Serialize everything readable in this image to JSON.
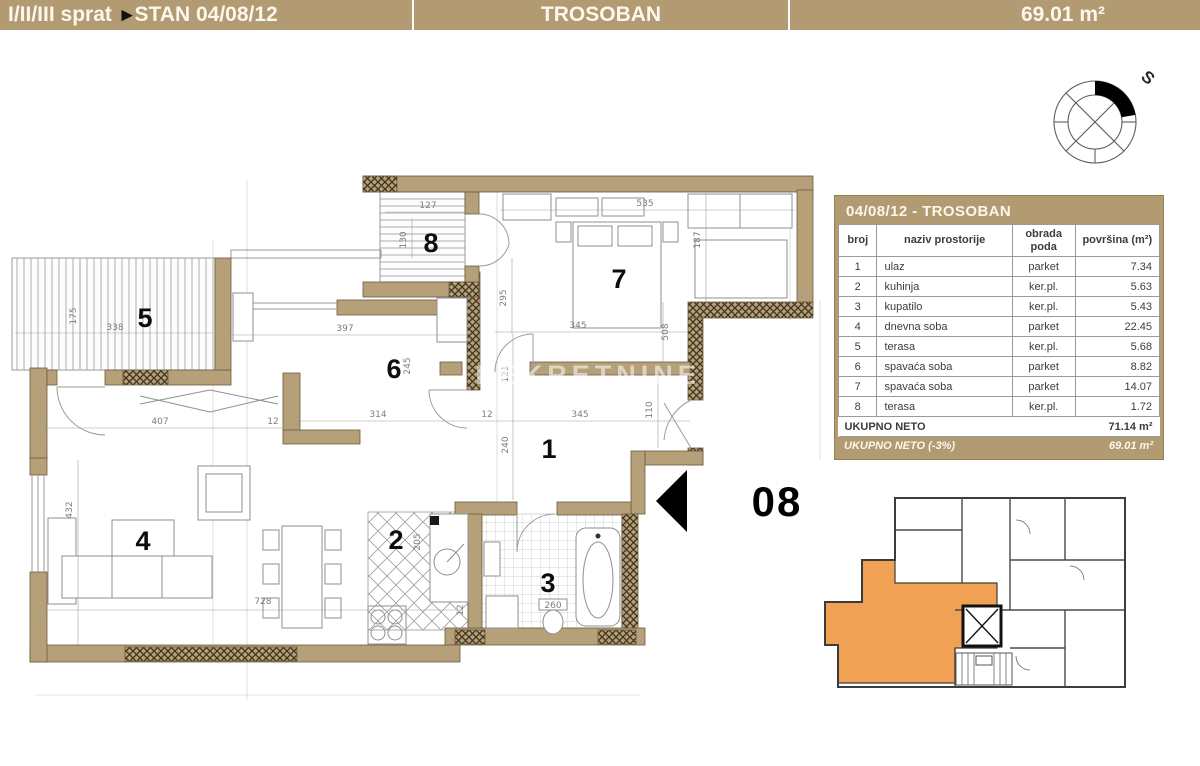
{
  "header": {
    "floors": "I/II/III sprat",
    "arrow_icon": "►",
    "unit": "STAN 04/08/12",
    "type": "TROSOBAN",
    "area": "69.01 m²"
  },
  "compass": {
    "north_label": "S"
  },
  "watermark": "NEKRETNINE",
  "unit_marker": {
    "label": "08"
  },
  "plan": {
    "rooms": [
      {
        "n": "5",
        "x": 145,
        "y": 327
      },
      {
        "n": "8",
        "x": 431,
        "y": 252
      },
      {
        "n": "7",
        "x": 619,
        "y": 288
      },
      {
        "n": "6",
        "x": 394,
        "y": 378
      },
      {
        "n": "1",
        "x": 549,
        "y": 458
      },
      {
        "n": "4",
        "x": 143,
        "y": 550
      },
      {
        "n": "2",
        "x": 396,
        "y": 549
      },
      {
        "n": "3",
        "x": 548,
        "y": 592
      }
    ],
    "dimensions": [
      {
        "t": "338",
        "x": 115,
        "y": 330
      },
      {
        "t": "175",
        "x": 76,
        "y": 316,
        "r": 1
      },
      {
        "t": "407",
        "x": 160,
        "y": 424
      },
      {
        "t": "12",
        "x": 273,
        "y": 424
      },
      {
        "t": "314",
        "x": 378,
        "y": 417
      },
      {
        "t": "12",
        "x": 487,
        "y": 417
      },
      {
        "t": "345",
        "x": 580,
        "y": 417
      },
      {
        "t": "121",
        "x": 508,
        "y": 374,
        "r": 1
      },
      {
        "t": "240",
        "x": 508,
        "y": 445,
        "r": 1
      },
      {
        "t": "110",
        "x": 652,
        "y": 410,
        "r": 1
      },
      {
        "t": "508",
        "x": 668,
        "y": 332,
        "r": 1
      },
      {
        "t": "345",
        "x": 578,
        "y": 328
      },
      {
        "t": "295",
        "x": 506,
        "y": 298,
        "r": 1
      },
      {
        "t": "535",
        "x": 645,
        "y": 206
      },
      {
        "t": "187",
        "x": 700,
        "y": 240,
        "r": 1
      },
      {
        "t": "127",
        "x": 428,
        "y": 208
      },
      {
        "t": "130",
        "x": 406,
        "y": 240,
        "r": 1
      },
      {
        "t": "397",
        "x": 345,
        "y": 331
      },
      {
        "t": "245",
        "x": 410,
        "y": 366,
        "r": 1
      },
      {
        "t": "432",
        "x": 72,
        "y": 510,
        "r": 1
      },
      {
        "t": "728",
        "x": 263,
        "y": 604
      },
      {
        "t": "205",
        "x": 420,
        "y": 542,
        "r": 1
      },
      {
        "t": "12",
        "x": 463,
        "y": 610,
        "r": 1
      },
      {
        "t": "260",
        "x": 553,
        "y": 608
      }
    ]
  },
  "table": {
    "title": "04/08/12 - TROSOBAN",
    "columns": [
      "broj",
      "naziv prostorije",
      "obrada poda",
      "površina (m²)"
    ],
    "rows": [
      [
        "1",
        "ulaz",
        "parket",
        "7.34"
      ],
      [
        "2",
        "kuhinja",
        "ker.pl.",
        "5.63"
      ],
      [
        "3",
        "kupatilo",
        "ker.pl.",
        "5.43"
      ],
      [
        "4",
        "dnevna soba",
        "parket",
        "22.45"
      ],
      [
        "5",
        "terasa",
        "ker.pl.",
        "5.68"
      ],
      [
        "6",
        "spavaća soba",
        "parket",
        "8.82"
      ],
      [
        "7",
        "spavaća soba",
        "parket",
        "14.07"
      ],
      [
        "8",
        "terasa",
        "ker.pl.",
        "1.72"
      ]
    ],
    "total_label": "UKUPNO NETO",
    "total_value": "71.14 m²",
    "net_label": "UKUPNO NETO (-3%)",
    "net_value": "69.01 m²"
  },
  "colors": {
    "tan": "#b29b72",
    "wall": "#b5a07a",
    "walledge": "#6b5a3c",
    "orange": "#f0a154"
  }
}
